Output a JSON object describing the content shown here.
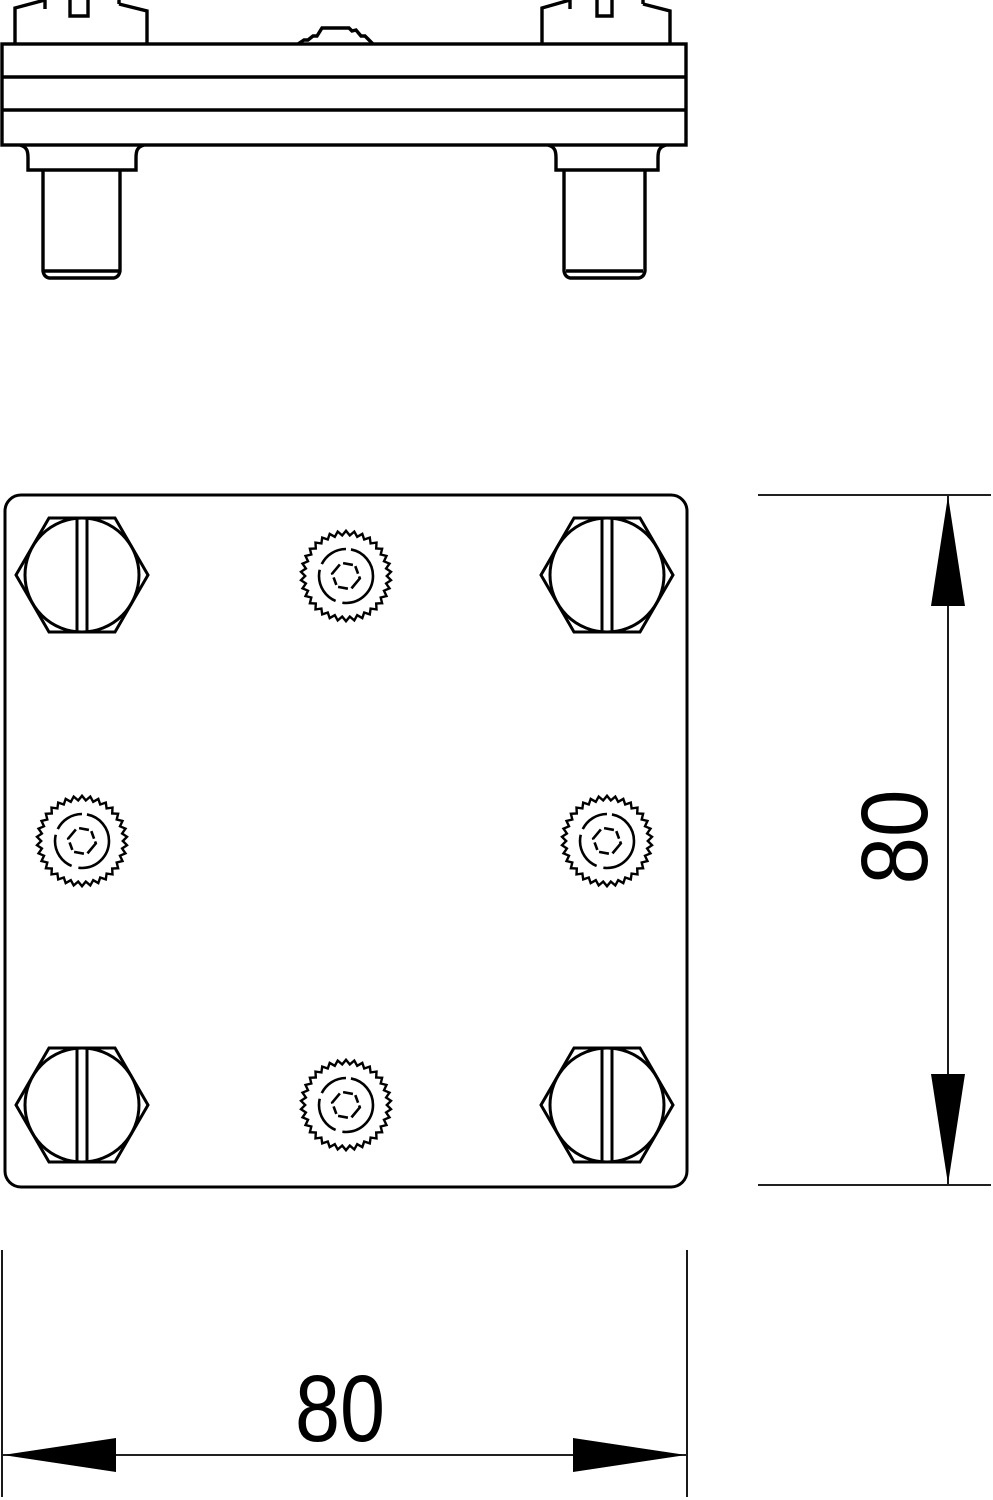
{
  "colors": {
    "line": "#000000",
    "background": "#ffffff"
  },
  "dimensions": {
    "width": {
      "label": "80",
      "orientation": "horizontal"
    },
    "height": {
      "label": "80",
      "orientation": "vertical"
    }
  }
}
